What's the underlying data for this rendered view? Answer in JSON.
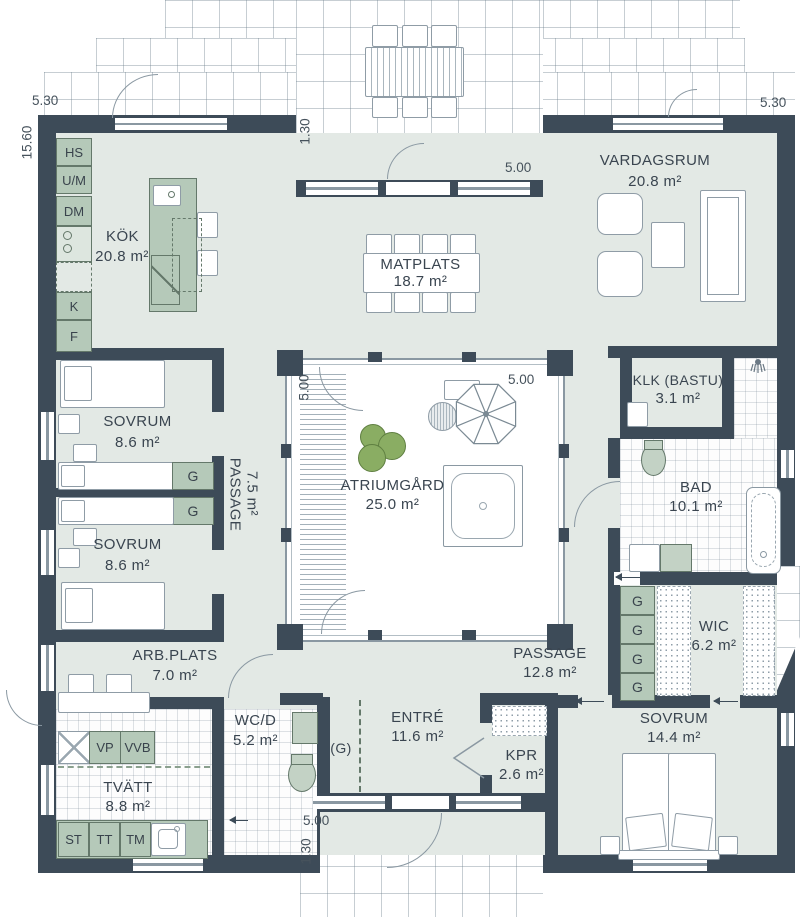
{
  "plan": {
    "title": "Atrium house floor plan",
    "rooms": {
      "kok": {
        "name": "KÖK",
        "area": "20.8 m²"
      },
      "matplats": {
        "name": "MATPLATS",
        "area": "18.7 m²"
      },
      "vardagsrum": {
        "name": "VARDAGSRUM",
        "area": "20.8 m²"
      },
      "atriumgard": {
        "name": "ATRIUMGÅRD",
        "area": "25.0 m²"
      },
      "sovrum1": {
        "name": "SOVRUM",
        "area": "8.6 m²"
      },
      "sovrum2": {
        "name": "SOVRUM",
        "area": "8.6 m²"
      },
      "passage1": {
        "name": "PASSAGE",
        "area": "7.5 m²"
      },
      "klk": {
        "name": "KLK (BASTU)",
        "area": "3.1 m²"
      },
      "bad": {
        "name": "BAD",
        "area": "10.1 m²"
      },
      "wic": {
        "name": "WIC",
        "area": "6.2 m²"
      },
      "passage2": {
        "name": "PASSAGE",
        "area": "12.8 m²"
      },
      "sovrum3": {
        "name": "SOVRUM",
        "area": "14.4 m²"
      },
      "arbplats": {
        "name": "ARB.PLATS",
        "area": "7.0 m²"
      },
      "tvatt": {
        "name": "TVÄTT",
        "area": "8.8 m²"
      },
      "wcd": {
        "name": "WC/D",
        "area": "5.2 m²"
      },
      "entre": {
        "name": "ENTRÉ",
        "area": "11.6 m²"
      },
      "kpr": {
        "name": "KPR",
        "area": "2.6 m²"
      }
    },
    "cabinets": {
      "hs": "HS",
      "um": "U/M",
      "dm": "DM",
      "k": "K",
      "f": "F"
    },
    "laundry": {
      "vp": "VP",
      "vvb": "VVB",
      "st": "ST",
      "tt": "TT",
      "tm": "TM"
    },
    "wardrobe": {
      "g": "G",
      "g_paren": "(G)"
    },
    "dims": {
      "d530": "5.30",
      "d1560": "15.60",
      "d130": "1.30",
      "d500": "5.00"
    },
    "colors": {
      "wall": "#3d4b58",
      "floor": "#e3e9e5",
      "fixture": "#b5c9b9",
      "fixture_border": "#64786a",
      "line": "#8a98a2",
      "bush": "#8aad63",
      "text": "#3a4550"
    }
  }
}
